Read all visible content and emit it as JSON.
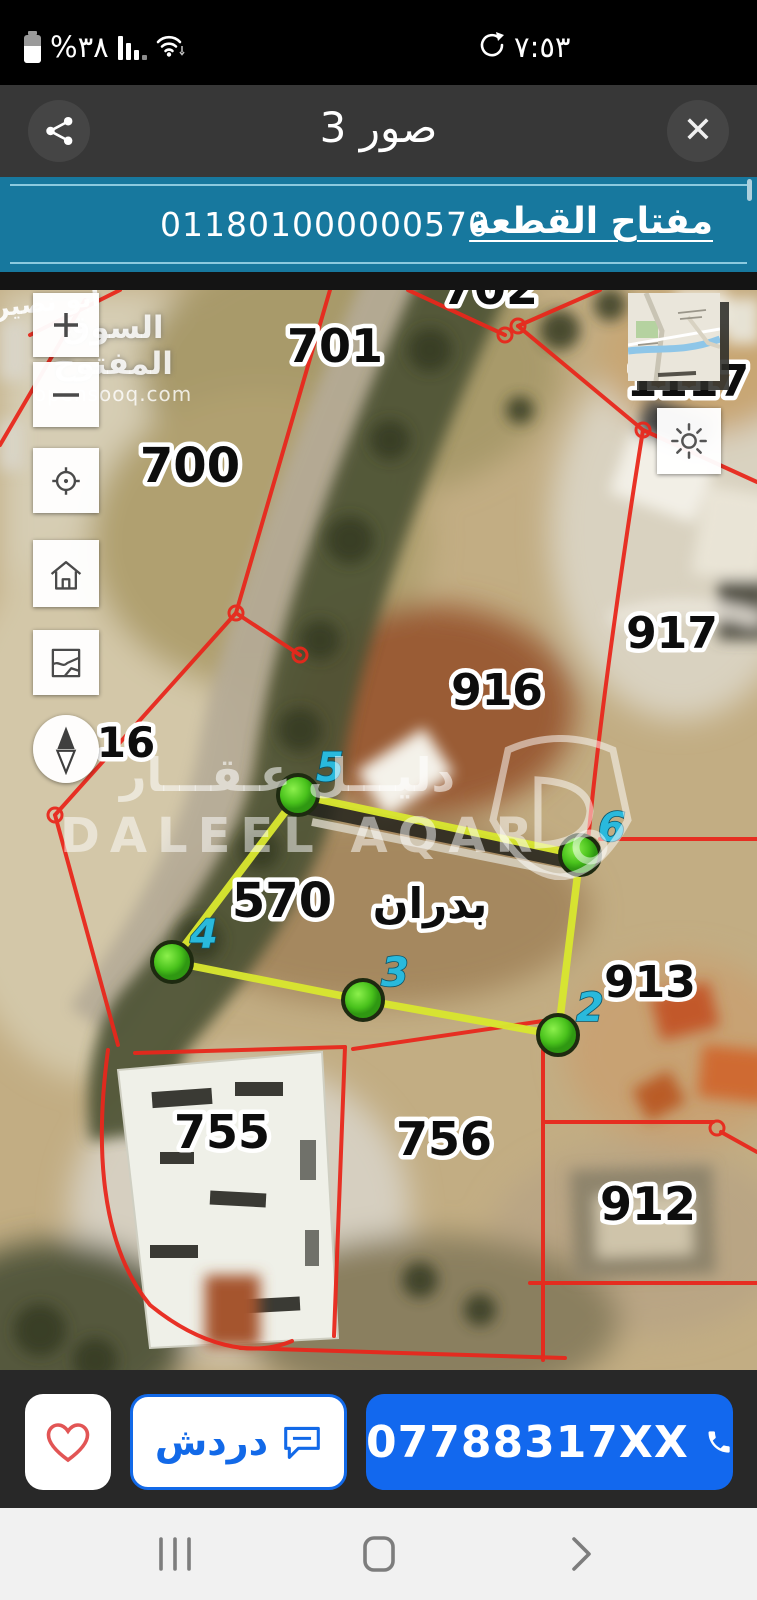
{
  "status_bar": {
    "battery_label": "%٣٨",
    "time": "٧:٥٣",
    "icons": [
      "battery-icon",
      "cellular-signal-icon",
      "wifi-icon",
      "sync-icon"
    ]
  },
  "header": {
    "title": "3 صور"
  },
  "plot_key_bar": {
    "label": "مفتاح القطعة",
    "value": "011801000000570"
  },
  "map": {
    "edge_label": "ابو نصير",
    "watermark_opensooq": {
      "arabic": "السوق المفتوح",
      "domain": "opensooq.com"
    },
    "watermark_daleel": {
      "arabic": "دليـــل عـقـــار",
      "latin": "DALEEL AQAR"
    },
    "parcel_labels": [
      {
        "id": "702",
        "text": "702",
        "x": 490,
        "y": 14,
        "size": 46
      },
      {
        "id": "701",
        "text": "701",
        "x": 335,
        "y": 72,
        "size": 46
      },
      {
        "id": "700",
        "text": "700",
        "x": 190,
        "y": 192,
        "size": 48
      },
      {
        "id": "1117",
        "text": "1117",
        "x": 688,
        "y": 106,
        "size": 44
      },
      {
        "id": "917",
        "text": "917",
        "x": 672,
        "y": 358,
        "size": 44
      },
      {
        "id": "916",
        "text": "916",
        "x": 497,
        "y": 415,
        "size": 44
      },
      {
        "id": "16",
        "text": "16",
        "x": 126,
        "y": 467,
        "size": 42
      },
      {
        "id": "570",
        "text": "570",
        "x": 282,
        "y": 627,
        "size": 48
      },
      {
        "id": "badran",
        "text": "بدران",
        "x": 430,
        "y": 628,
        "size": 42
      },
      {
        "id": "913",
        "text": "913",
        "x": 650,
        "y": 707,
        "size": 44
      },
      {
        "id": "755",
        "text": "755",
        "x": 222,
        "y": 858,
        "size": 46
      },
      {
        "id": "756",
        "text": "756",
        "x": 444,
        "y": 865,
        "size": 46
      },
      {
        "id": "912",
        "text": "912",
        "x": 648,
        "y": 930,
        "size": 46
      }
    ],
    "plot570": {
      "points": [
        {
          "label": "5",
          "x": 298,
          "y": 505
        },
        {
          "label": "6",
          "x": 580,
          "y": 565
        },
        {
          "label": "2",
          "x": 558,
          "y": 745
        },
        {
          "label": "3",
          "x": 363,
          "y": 710
        },
        {
          "label": "4",
          "x": 172,
          "y": 672
        }
      ]
    },
    "colors": {
      "boundary_red": "#e8271c",
      "plot_yellow": "#d8e52f",
      "vertex_green": "#55cc22",
      "vertex_label_cyan": "#29b9dc"
    },
    "controls": [
      "zoom-in",
      "zoom-out",
      "locate",
      "home",
      "layers",
      "compass",
      "brightness",
      "minimap"
    ]
  },
  "action_bar": {
    "chat_label": "دردش",
    "phone_label": "07788317XX",
    "phone_color": "#1268ee",
    "favorite_color": "#e25555"
  },
  "nav_bar": {
    "icons": [
      "recents-icon",
      "home-icon",
      "back-icon"
    ]
  }
}
